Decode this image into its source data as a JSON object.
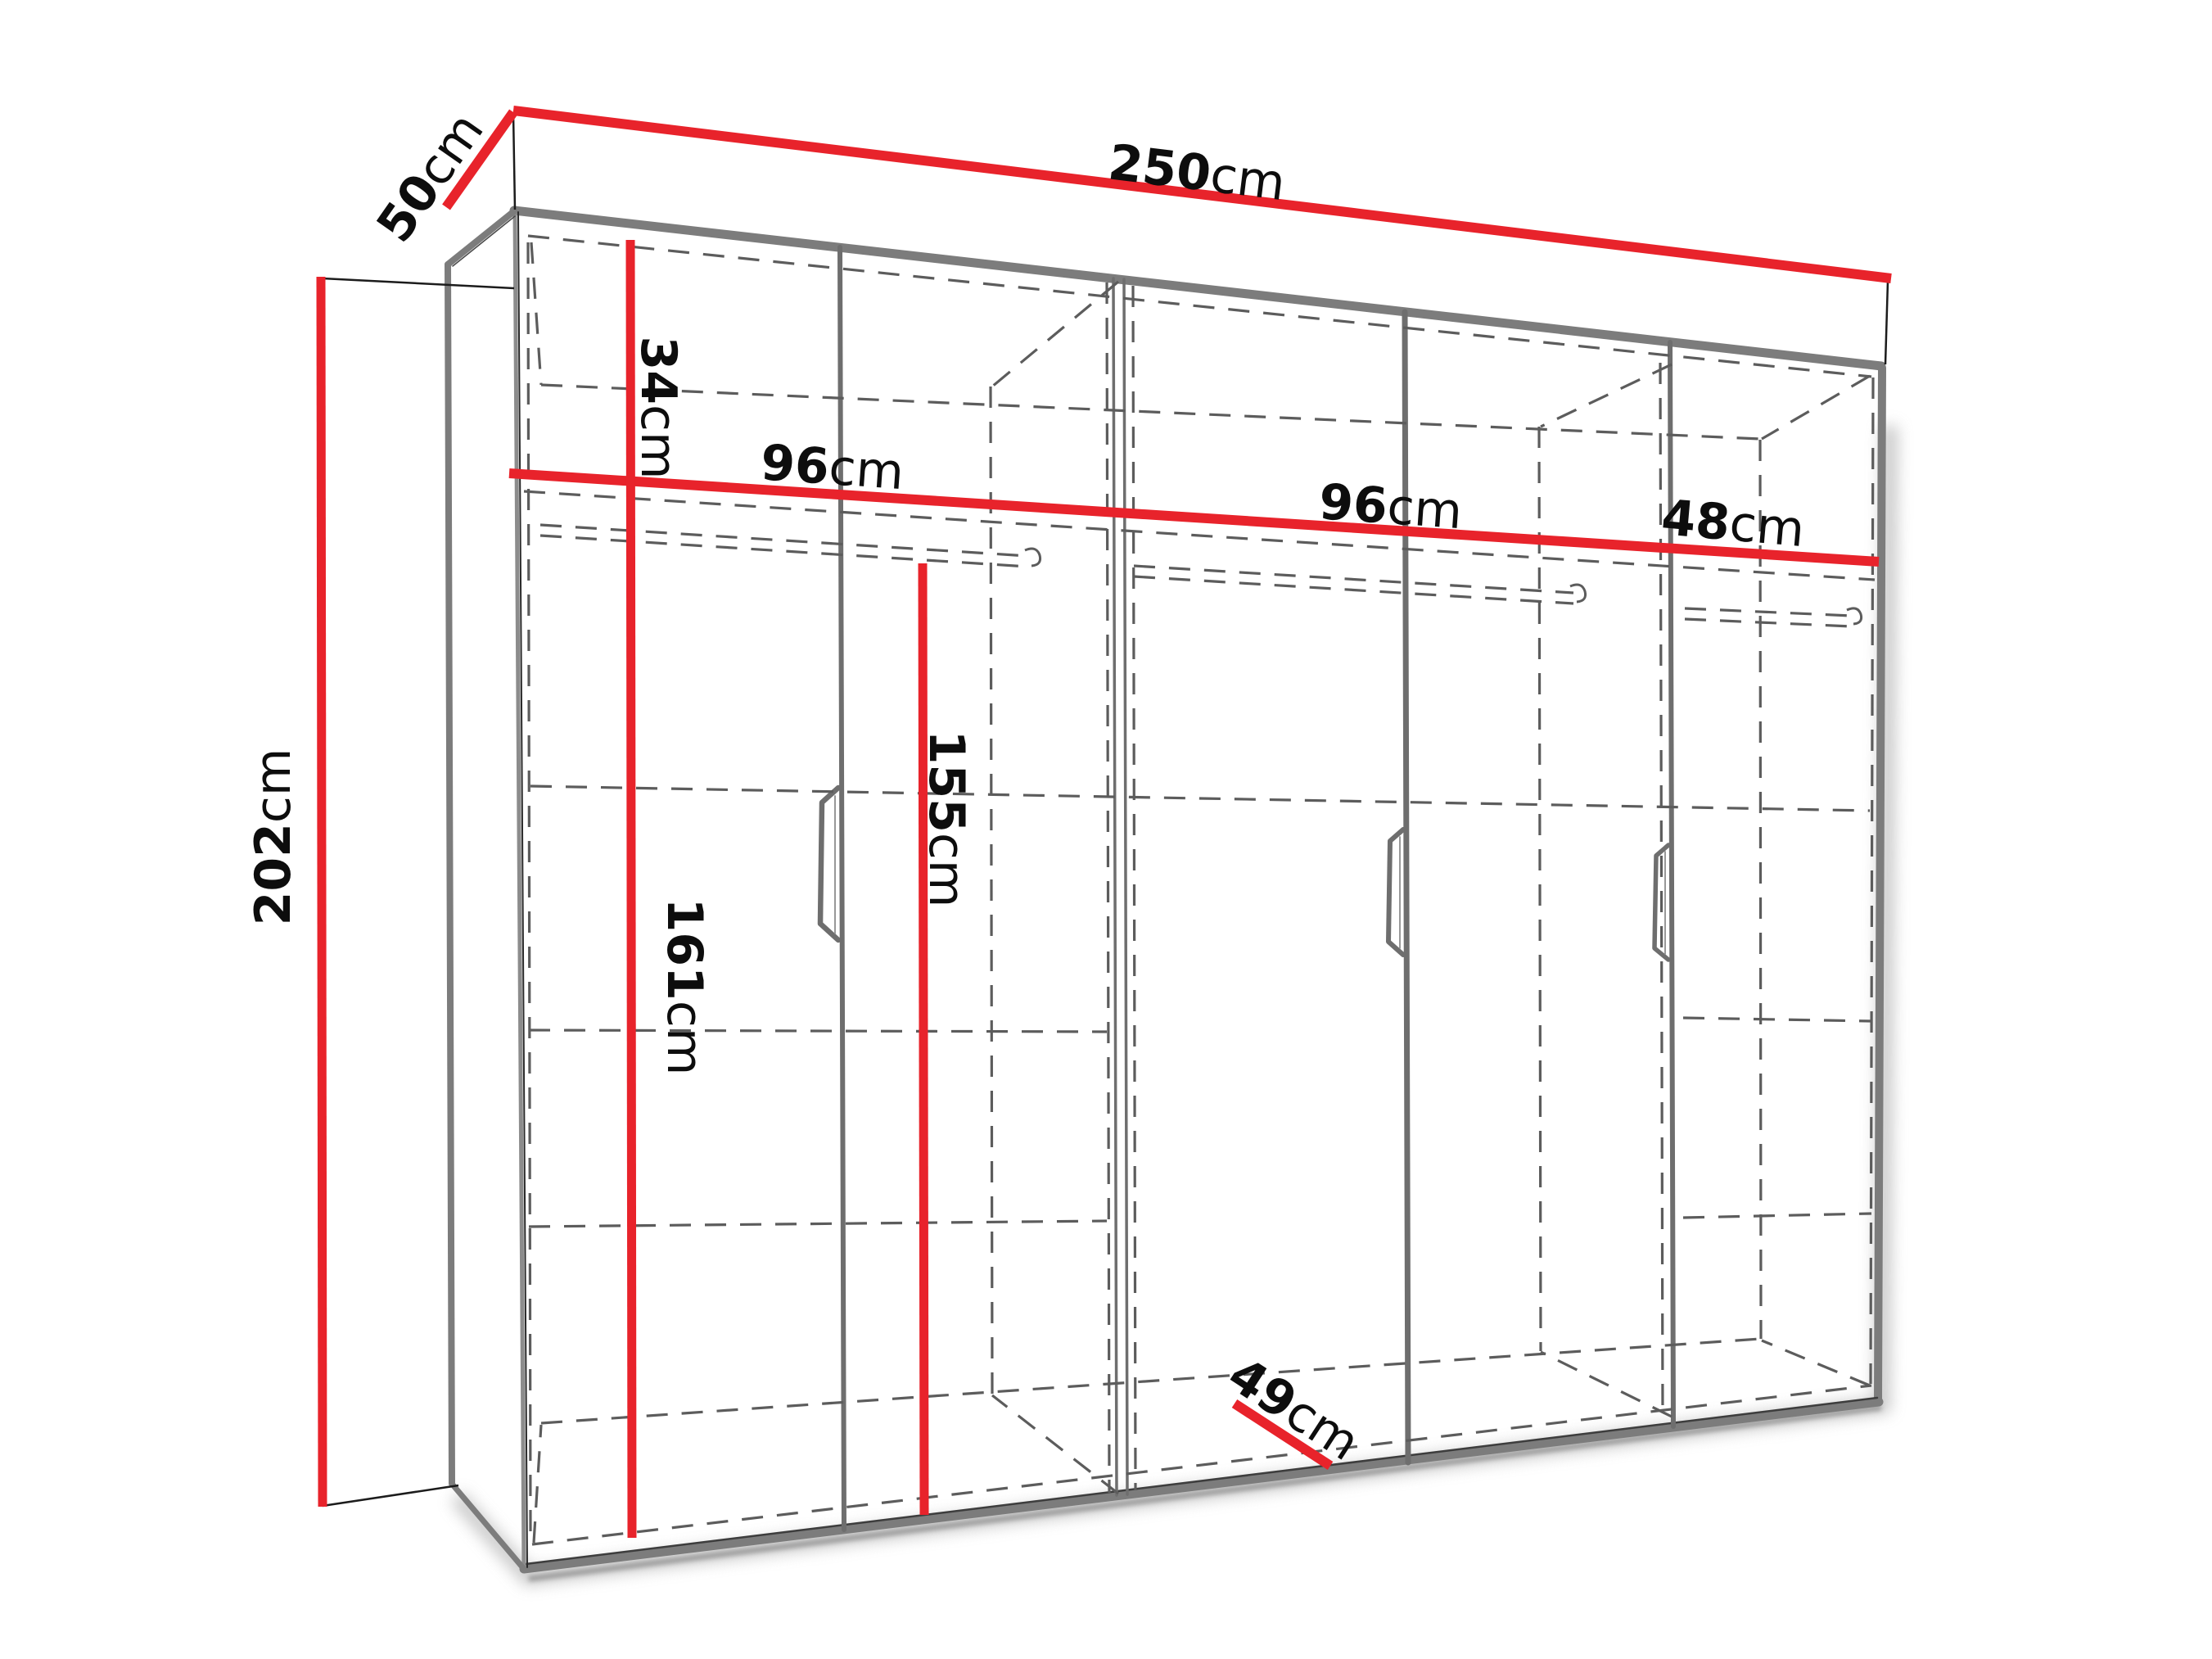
{
  "diagram": {
    "type": "wardrobe-dimension-diagram",
    "unit": "cm",
    "dimensions": {
      "width": {
        "num": "250",
        "unit": "cm"
      },
      "depth": {
        "num": "50",
        "unit": "cm"
      },
      "height": {
        "num": "202",
        "unit": "cm"
      },
      "top_section": {
        "num": "34",
        "unit": "cm"
      },
      "shelf_left": {
        "num": "96",
        "unit": "cm"
      },
      "shelf_middle": {
        "num": "96",
        "unit": "cm"
      },
      "shelf_right": {
        "num": "48",
        "unit": "cm"
      },
      "interior_height": {
        "num": "161",
        "unit": "cm"
      },
      "hanging_height": {
        "num": "155",
        "unit": "cm"
      },
      "interior_depth": {
        "num": "49",
        "unit": "cm"
      }
    },
    "colors": {
      "dimension_red": "#e8232b",
      "outline_gray": "#7c7c7c",
      "dashed_gray": "#5c5c5c",
      "text_black": "#0d0d0d",
      "background": "#ffffff"
    },
    "features": {
      "doors": 5,
      "handles": 3,
      "hanging_rods": 3,
      "sections": 3
    }
  }
}
